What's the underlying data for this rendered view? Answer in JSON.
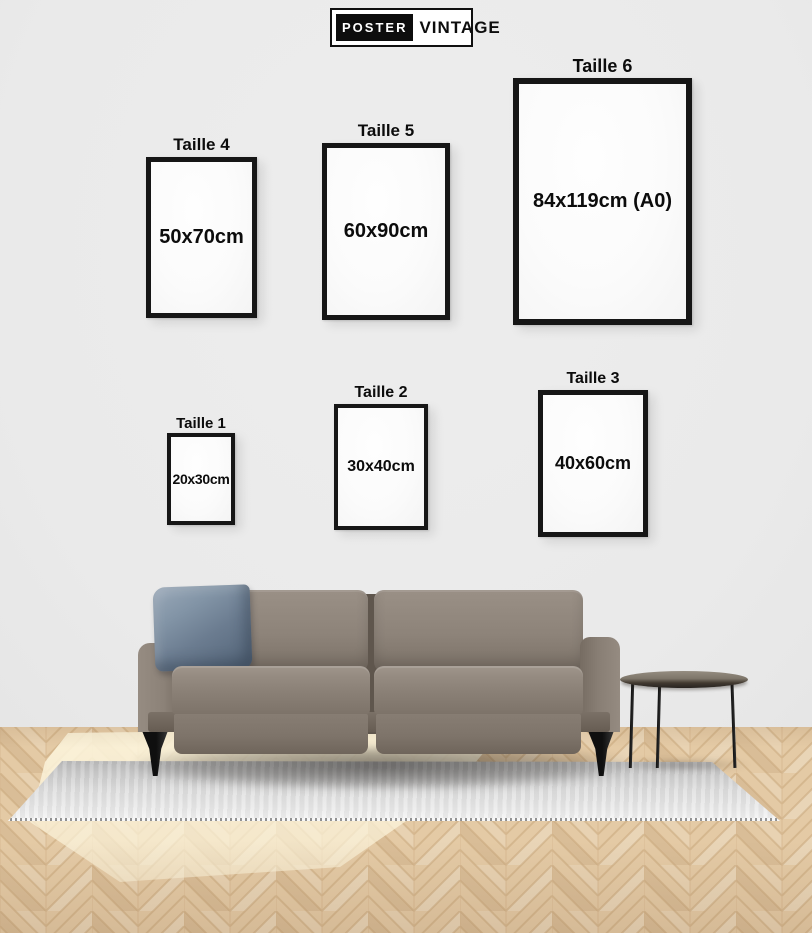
{
  "brand": {
    "poster_label": "POSTER",
    "vintage_label": "VINTAGE"
  },
  "size_guide": {
    "frames": [
      {
        "label": "Taille 4",
        "size": "50x70cm"
      },
      {
        "label": "Taille 5",
        "size": "60x90cm"
      },
      {
        "label": "Taille 6",
        "size": "84x119cm (A0)"
      },
      {
        "label": "Taille 1",
        "size": "20x30cm"
      },
      {
        "label": "Taille 2",
        "size": "30x40cm"
      },
      {
        "label": "Taille 3",
        "size": "40x60cm"
      }
    ]
  },
  "colors": {
    "wall": "#ebebeb",
    "frame_border": "#161616",
    "frame_fill": "#fbfbfb",
    "text": "#0c0c0c",
    "logo_badge_bg": "#0d0d0d",
    "logo_badge_text": "#ffffff",
    "sofa_body": "#8b8177",
    "pillow": "#6f8093",
    "rug": "#d8d8d8",
    "floor_wood": "#e2c8a3",
    "table_top": "#3c342b"
  }
}
